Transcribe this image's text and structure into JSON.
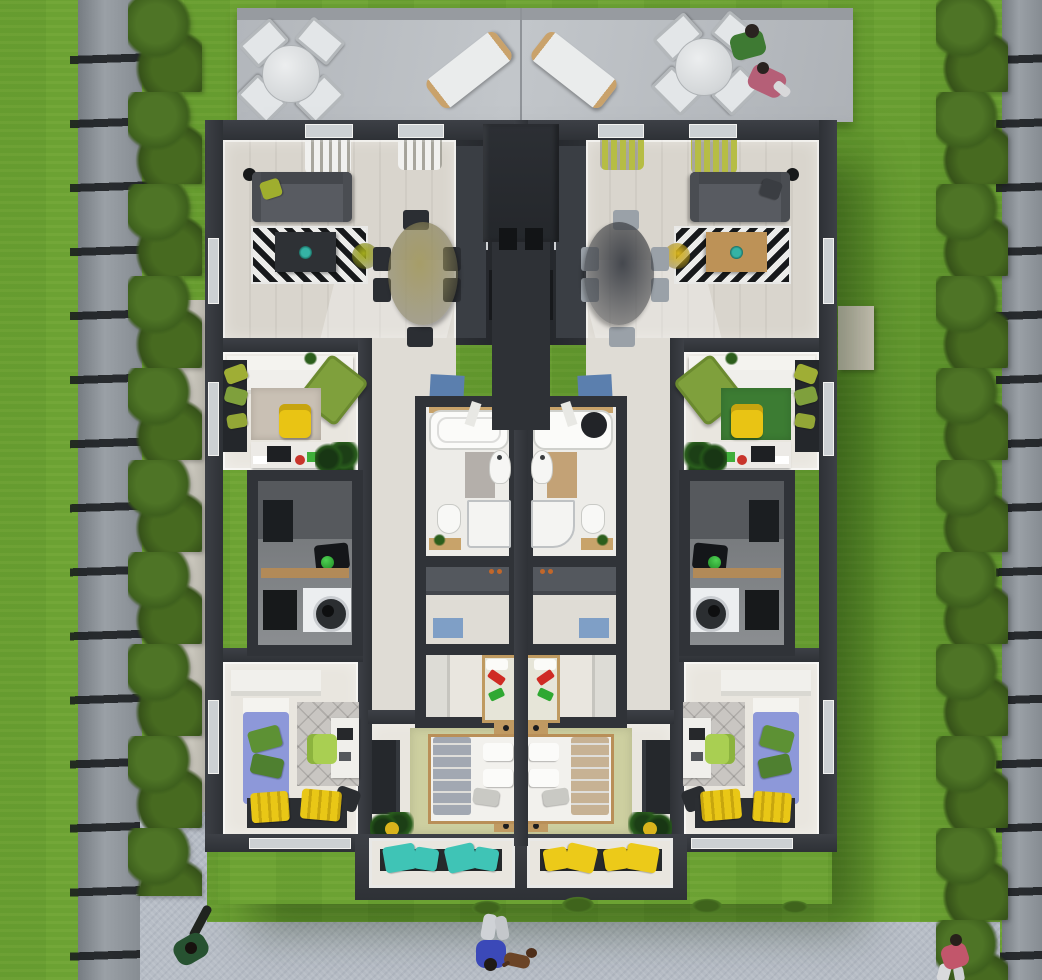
{
  "scene": {
    "type": "architectural-3d-floor-plan",
    "view": "top-down bird's eye",
    "description": "Mirrored duplex apartment with furnished interiors, rear concrete patio, side lawns with hedges and panel fences, and a front sidewalk with pedestrians",
    "units": [
      {
        "id": "left",
        "label": "Left apartment unit",
        "rooms": [
          {
            "name": "living-dining-kitchen",
            "furniture": [
              "gray sofa with olive cushion",
              "black floor lamp",
              "black and white chevron rug",
              "dark coffee table with teal plant",
              "olive round side table",
              "olive oval dining table",
              "six dark dining chairs",
              "white curtains",
              "dark kitchen counter along core wall",
              "blue entry doormat"
            ]
          },
          {
            "name": "office-guest-room",
            "furniture": [
              "white daybed",
              "olive lounge chair",
              "green scatter cushions on dark bench",
              "beige rug",
              "yellow desk chair",
              "white desk with laptop, red cup",
              "potted plant"
            ]
          },
          {
            "name": "bathroom",
            "furniture": [
              "bathtub",
              "wall-hung basin",
              "gray bath mat",
              "toilet",
              "walk-in shower",
              "wooden shelf with plant"
            ]
          },
          {
            "name": "utility-laundry",
            "furniture": [
              "concrete walls",
              "wooden worktop",
              "black holdall with green ball",
              "washing machine",
              "open dark cabinet"
            ]
          },
          {
            "name": "dressing-hall",
            "furniture": [
              "gray built-in wardrobe",
              "blue doormat"
            ]
          },
          {
            "name": "kids-room",
            "furniture": [
              "white wardrobe",
              "wooden single bed",
              "red toy",
              "green toy"
            ]
          },
          {
            "name": "guest-bedroom",
            "furniture": [
              "white built-in wardrobe",
              "blue daybed with green cushions",
              "quilted gray rug",
              "white desk",
              "lime desk chair",
              "black office chair",
              "window bench with yellow cushions"
            ]
          },
          {
            "name": "master-bedroom",
            "furniture": [
              "wooden double bed with gray duvet",
              "two wooden nightstands with lamps",
              "dark wardrobe",
              "olive rug",
              "plant in yellow pot",
              "bay window bench with teal cushions"
            ]
          }
        ]
      },
      {
        "id": "right",
        "label": "Right apartment unit (mirrored)",
        "rooms": [
          {
            "name": "living-dining-kitchen",
            "furniture": [
              "gray sofa",
              "olive-green curtains",
              "black and white chevron rug",
              "wooden coffee table",
              "yellow round side table",
              "dark gray oval dining table",
              "six light gray dining chairs",
              "dark kitchen counter",
              "blue entry doormat"
            ]
          },
          {
            "name": "office-guest-room",
            "furniture": [
              "white daybed",
              "olive lounge chair",
              "dark green rug",
              "yellow desk chair",
              "white desk with monitor",
              "potted plant"
            ]
          },
          {
            "name": "bathroom",
            "furniture": [
              "white counter with round black basin",
              "wall-hung basin",
              "tan bath mat",
              "toilet",
              "curved walk-in shower",
              "wooden shelf with plant"
            ]
          },
          {
            "name": "utility-laundry",
            "furniture": [
              "concrete walls",
              "wooden worktop",
              "black holdall with green ball",
              "washing machine"
            ]
          },
          {
            "name": "dressing-hall",
            "furniture": [
              "gray built-in wardrobe",
              "blue doormat"
            ]
          },
          {
            "name": "kids-room",
            "furniture": [
              "white wardrobe",
              "wooden single bed",
              "red toy",
              "green toy"
            ]
          },
          {
            "name": "guest-bedroom",
            "furniture": [
              "blue daybed with green cushions",
              "quilted gray rug",
              "white desk",
              "lime desk chair",
              "window bench with yellow cushions"
            ]
          },
          {
            "name": "master-bedroom",
            "furniture": [
              "wooden double bed with tan patterned duvet",
              "two wooden nightstands",
              "dark wardrobe",
              "olive rug",
              "potted plant",
              "bay window bench with yellow cushions"
            ]
          }
        ]
      }
    ],
    "site": {
      "patio": [
        "round bistro table with four white chairs (left)",
        "round bistro table with four white chairs and two seated people (right)",
        "two sun loungers"
      ],
      "garden": [
        "lawn with mowing stripes",
        "boxwood hedge rows",
        "gray panel fences with dark posts",
        "side walkway",
        "front sidewalk"
      ]
    },
    "people": [
      {
        "location": "right patio table",
        "appearance": "person in green shirt"
      },
      {
        "location": "right patio table",
        "appearance": "person in pink outfit"
      },
      {
        "location": "left path",
        "appearance": "walker in dark green"
      },
      {
        "location": "front sidewalk center",
        "appearance": "walker in blue shirt with dog"
      },
      {
        "location": "front sidewalk right",
        "appearance": "walker in pink top and white trousers"
      }
    ],
    "pets": [
      {
        "type": "dog",
        "color": "brown",
        "location": "front sidewalk center"
      }
    ],
    "palette": {
      "grass": "#6ca233",
      "hedge": "#44661f",
      "fence": "#8d939a",
      "patio": "#b6bac0",
      "sidewalk": "#b7bdc6",
      "wall": "#34373d",
      "wood_floor": "#d9d5cd",
      "pale_floor": "#e9e6df",
      "concrete": "#777a7e",
      "sofa_gray": "#56595f",
      "olive": "#a4ac1c",
      "yellow": "#e9c416",
      "teal": "#43c4b6",
      "bed_blue": "#8d98d9",
      "mat_blue": "#5b7fae",
      "toy_red": "#cf2b24",
      "toy_green": "#2fa832",
      "wood": "#bf9a60",
      "curtain_white": "#f1f1ef",
      "curtain_olive": "#b6bd45",
      "dining_dark": "#45484e",
      "blanket_gray": "#a2a8b2",
      "blanket_tan": "#c7b294"
    }
  }
}
